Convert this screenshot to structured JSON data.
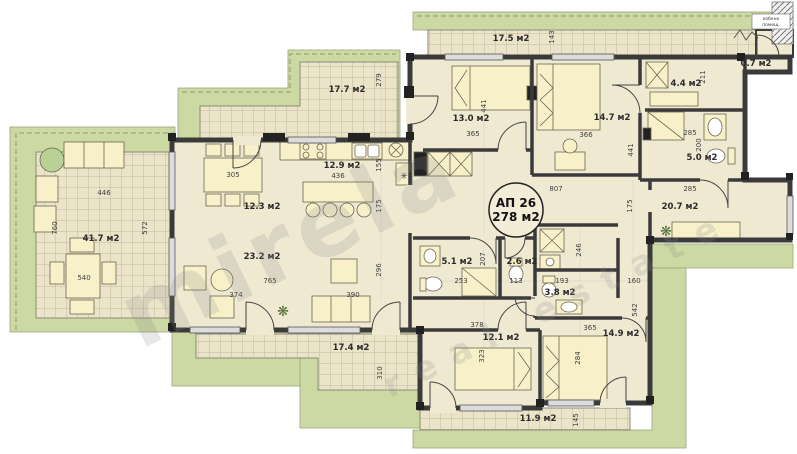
{
  "apartment": {
    "id": "АП 26",
    "area": "278 м2"
  },
  "rooms": {
    "terrace_left": "41.7 м2",
    "terrace_mid": "17.7 м2",
    "terrace_top": "17.5 м2",
    "kitchen": "12.9 м2",
    "dining": "12.3 м2",
    "living": "23.2 м2",
    "bedroom1": "13.0 м2",
    "bedroom2": "14.7 м2",
    "closet": "4.4 м2",
    "shaft": "0.7 м2",
    "bath2": "5.0 м2",
    "hall": "20.7 м2",
    "bath1": "5.1 м2",
    "wc1": "2.6 м2",
    "wc2": "3.8 м2",
    "bedroom3": "12.1 м2",
    "bedroom4": "14.9 м2",
    "terrace_bottom": "17.4 м2",
    "terrace_bottom2": "11.9 м2"
  },
  "dims": {
    "tl_w": "446",
    "tl_h1": "760",
    "tl_h2": "572",
    "tl_table": "540",
    "dining_table": "305",
    "kitchen_w": "436",
    "kitchen_h": "155",
    "tmid_h": "279",
    "living_h1": "175",
    "living_h2": "296",
    "living_w": "765",
    "living_s1": "374",
    "living_s2": "390",
    "tbot_h": "310",
    "bed1_w": "365",
    "bed1_h": "441",
    "bed2_w": "366",
    "bed2_h": "441",
    "hall_w": "807",
    "ttop_h": "143",
    "closet_h": "211",
    "bath2_w": "285",
    "bath2_h": "200",
    "hall_right_w": "285",
    "hall_right_h": "175",
    "corridor_w": "160",
    "right_h": "542",
    "bath1_w": "253",
    "bath1_h": "207",
    "wc1_w": "113",
    "wc2_w": "193",
    "closet2_h": "246",
    "corr_w": "378",
    "bed3_h": "323",
    "bed4_w": "365",
    "bed4_h": "284",
    "tbot2_h": "145"
  },
  "annotations": {
    "stair_label_line1": "избено",
    "stair_label_line2": "помещ."
  },
  "watermark": {
    "brand": "mirela",
    "tagline": "real estate"
  },
  "icons": {
    "plant": "❋",
    "freezer": "✳"
  },
  "colors": {
    "terrace_green": "#cdd9a3",
    "floor": "#f0e9d2",
    "tile": "#ece4c8",
    "wall": "#3a3a3a",
    "furniture": "#f7f0c9",
    "accent_green": "#b8cf96",
    "dim_text": "#3f3f3f",
    "watermark": "#8a8a8a"
  }
}
